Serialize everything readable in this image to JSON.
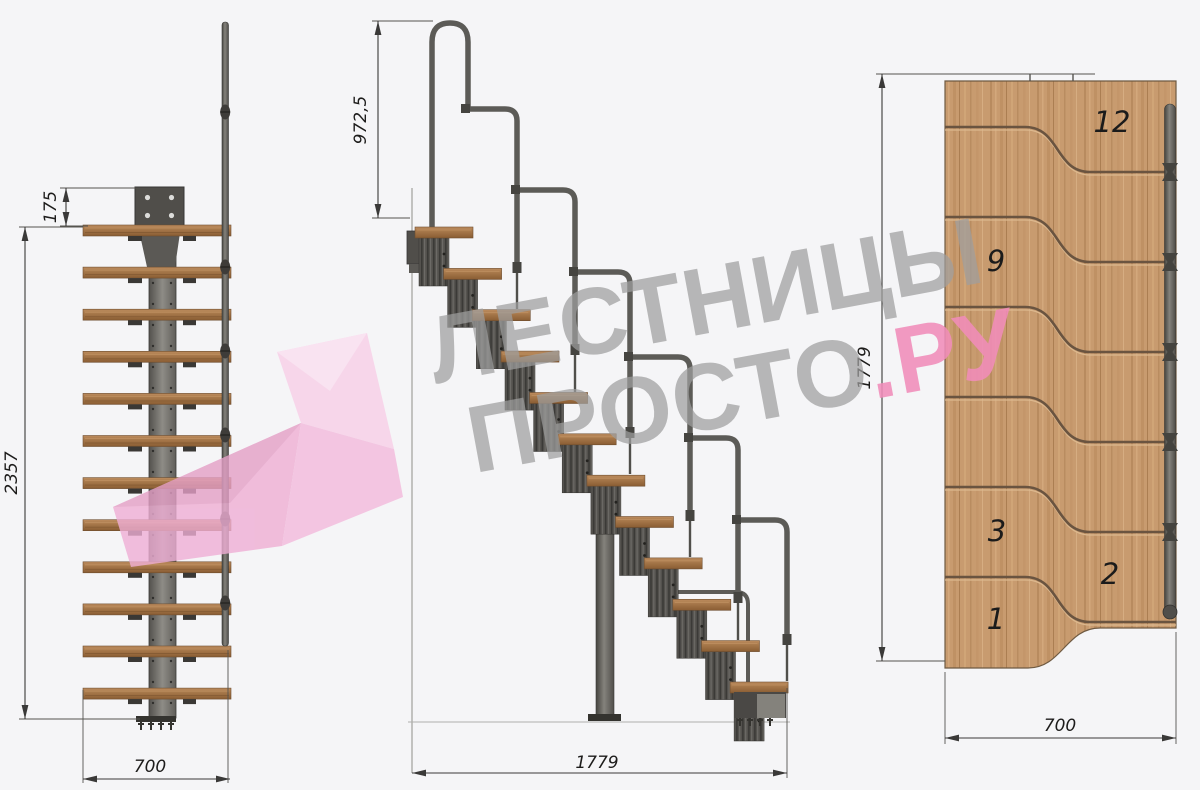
{
  "watermark": {
    "line1": "ЛЕСТНИЦЫ",
    "line2": "ПРОСТО",
    "line2_suffix": ".РУ",
    "gray_color": "#9e9e9e",
    "accent_color": "#f08cb9"
  },
  "brand_logo_color": "#f3badc",
  "views": {
    "front": {
      "name": "front-elevation",
      "dimensions": {
        "bracket_offset": "175",
        "total_height": "2357",
        "width": "700"
      }
    },
    "side": {
      "name": "side-elevation",
      "dimensions": {
        "handrail_height": "972,5",
        "length": "1779"
      }
    },
    "plan": {
      "name": "top-plan",
      "dimensions": {
        "length": "1779",
        "width": "700"
      },
      "step_labels": [
        "12",
        "9",
        "3",
        "2",
        "1"
      ]
    }
  },
  "colors": {
    "background": "#f5f5f7",
    "wood": "#c89b6f",
    "metal_dark": "#45443f",
    "metal_mid": "#84827c",
    "dimension_lines": "#3a3938"
  }
}
